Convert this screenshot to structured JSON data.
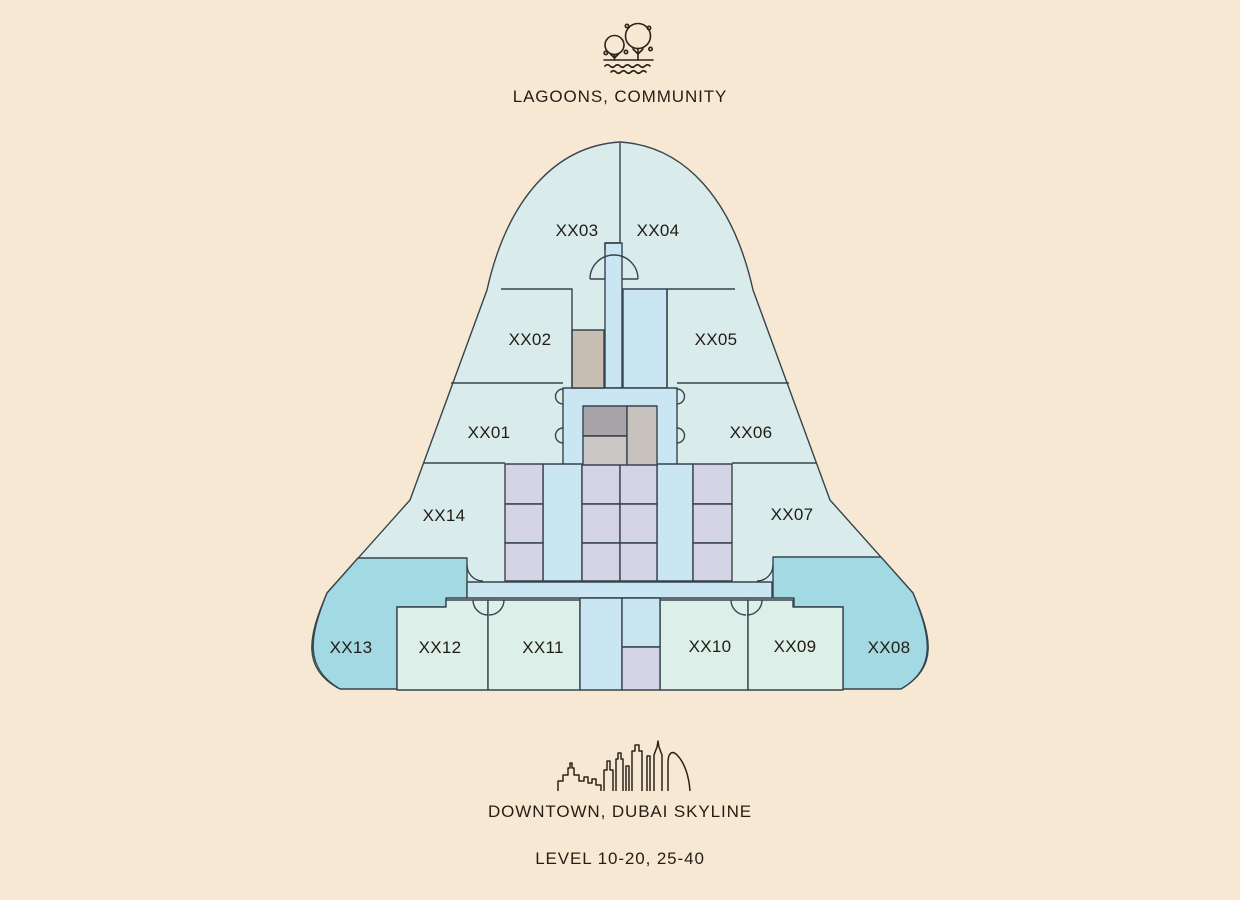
{
  "top_label": {
    "text": "LAGOONS, COMMUNITY",
    "icon": "lagoon-trees-icon"
  },
  "bottom_labels": {
    "skyline": "DOWNTOWN, DUBAI SKYLINE",
    "levels": "LEVEL 10-20, 25-40",
    "icon": "dubai-skyline-icon"
  },
  "floorplan": {
    "units": [
      {
        "id": "XX01",
        "label": "XX01"
      },
      {
        "id": "XX02",
        "label": "XX02"
      },
      {
        "id": "XX03",
        "label": "XX03"
      },
      {
        "id": "XX04",
        "label": "XX04"
      },
      {
        "id": "XX05",
        "label": "XX05"
      },
      {
        "id": "XX06",
        "label": "XX06"
      },
      {
        "id": "XX07",
        "label": "XX07"
      },
      {
        "id": "XX08",
        "label": "XX08"
      },
      {
        "id": "XX09",
        "label": "XX09"
      },
      {
        "id": "XX10",
        "label": "XX10"
      },
      {
        "id": "XX11",
        "label": "XX11"
      },
      {
        "id": "XX12",
        "label": "XX12"
      },
      {
        "id": "XX13",
        "label": "XX13"
      },
      {
        "id": "XX14",
        "label": "XX14"
      }
    ],
    "colors": {
      "page_background": "#f7e8d3",
      "base": "#d9eceb",
      "room": "#dcefe8",
      "corridor": "#cbe6f3",
      "storage": "#d5d3e6",
      "corner_unit": "#a3d9e3",
      "core_dark": "#a8a4a7",
      "core_light": "#cac6c6",
      "service": "#c6bdb3",
      "service_light": "#c6c1bd",
      "wall": "#37444c",
      "text": "#211c15"
    }
  }
}
